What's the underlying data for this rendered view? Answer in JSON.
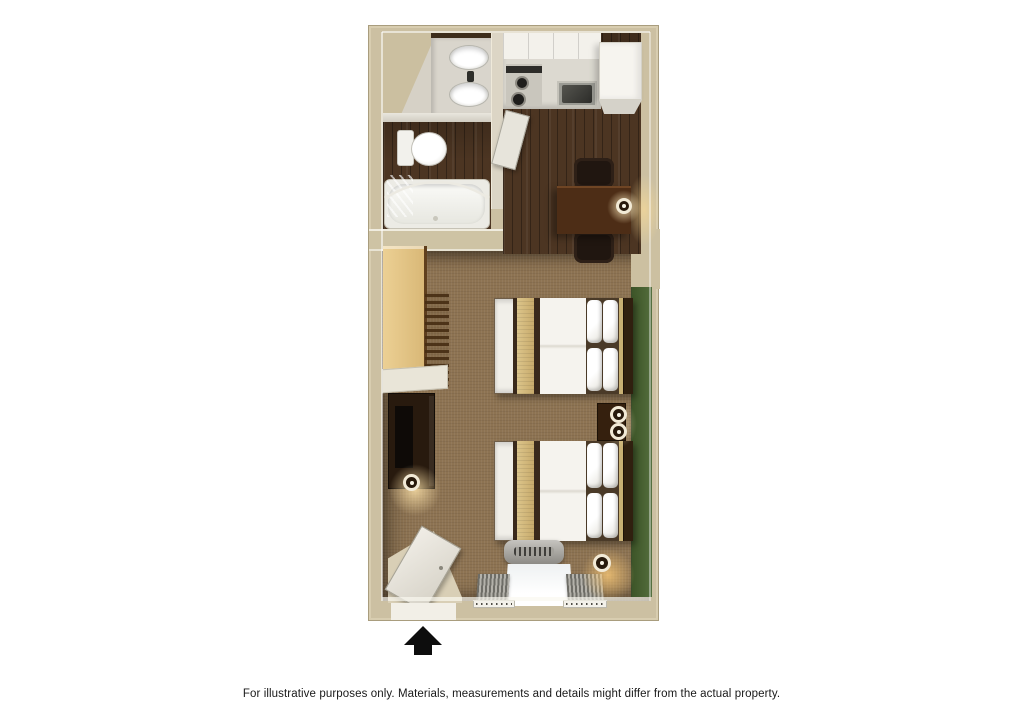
{
  "caption": "For illustrative purposes only.  Materials, measurements and details might differ from the actual property.",
  "floorplan": {
    "description": "3D top-down rendering of a studio suite with two double beds",
    "entrance_marker": "black arrow pointing up at bottom entry door",
    "rooms": {
      "bathroom": {
        "fixtures": [
          "vanity with two oval sinks",
          "toilet",
          "bathtub with curved shower rod",
          "towel"
        ]
      },
      "kitchen": {
        "fixtures": [
          "upper cabinets",
          "range with two burners",
          "stainless sink",
          "refrigerator",
          "open cabinet door"
        ]
      },
      "dining": {
        "furniture": [
          "square dark-wood table",
          "two dark chairs",
          "table lamp"
        ]
      },
      "sleeping_area": {
        "furniture": [
          "closet with hanging rod and hangers",
          "media dresser with tv",
          "floor lamp",
          "double bed with tan runner",
          "double bed with tan runner",
          "nightstand with two lamps"
        ]
      },
      "entry": {
        "features": [
          "entry door ajar",
          "window with gray curtains",
          "hvac unit under window",
          "corner lamp"
        ]
      }
    },
    "colors": {
      "background": "#ffffff",
      "wall": "#ccc0a2",
      "carpet": "#8d7352",
      "wood_floor": "#4c3522",
      "accent_wall_green": "#46602f",
      "bed_runner_tan": "#d2b87c",
      "dark_furniture": "#30200f",
      "closet_maple": "#e2c385",
      "arrow": "#0d0d0d"
    }
  },
  "icons": {
    "entrance_arrow": "up-arrow"
  }
}
